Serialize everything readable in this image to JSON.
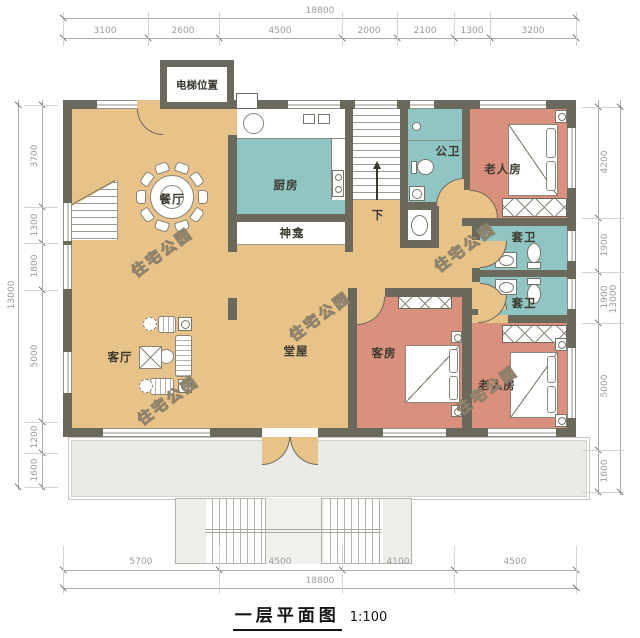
{
  "title": {
    "text": "一层平面图",
    "scale": "1:100"
  },
  "watermark": {
    "text": "住宅公园"
  },
  "labels": {
    "elevator": "电梯位置",
    "dining": "餐厅",
    "kitchen": "厨房",
    "shrine": "神龛",
    "public_bath": "公卫",
    "elder_room_top": "老人房",
    "ensuite_top": "套卫",
    "ensuite_bottom": "套卫",
    "hall": "堂屋",
    "living": "客厅",
    "guest": "客房",
    "elder_room_bottom": "老人房",
    "stairs_down": "下"
  },
  "dimensions": {
    "top": {
      "total": "18800",
      "segments": [
        "3100",
        "2600",
        "4500",
        "2000",
        "2100",
        "1300",
        "3200"
      ]
    },
    "bottom": {
      "total": "18800",
      "segments": [
        "5700",
        "4500",
        "4100",
        "4500"
      ]
    },
    "left": {
      "total": "13000",
      "segments": [
        "3700",
        "1300",
        "1800",
        "5000",
        "1200",
        "1600"
      ]
    },
    "right": {
      "total": "13000",
      "segments": [
        "4200",
        "1900",
        "1900",
        "5000",
        "1600"
      ]
    }
  },
  "colors": {
    "floor_tan": "#E7C289",
    "room_teal": "#8FC5C3",
    "room_salmon": "#D9907D",
    "wall": "#6B685C",
    "porch": "#EAEAE7",
    "dim_text": "#9C9C98"
  }
}
